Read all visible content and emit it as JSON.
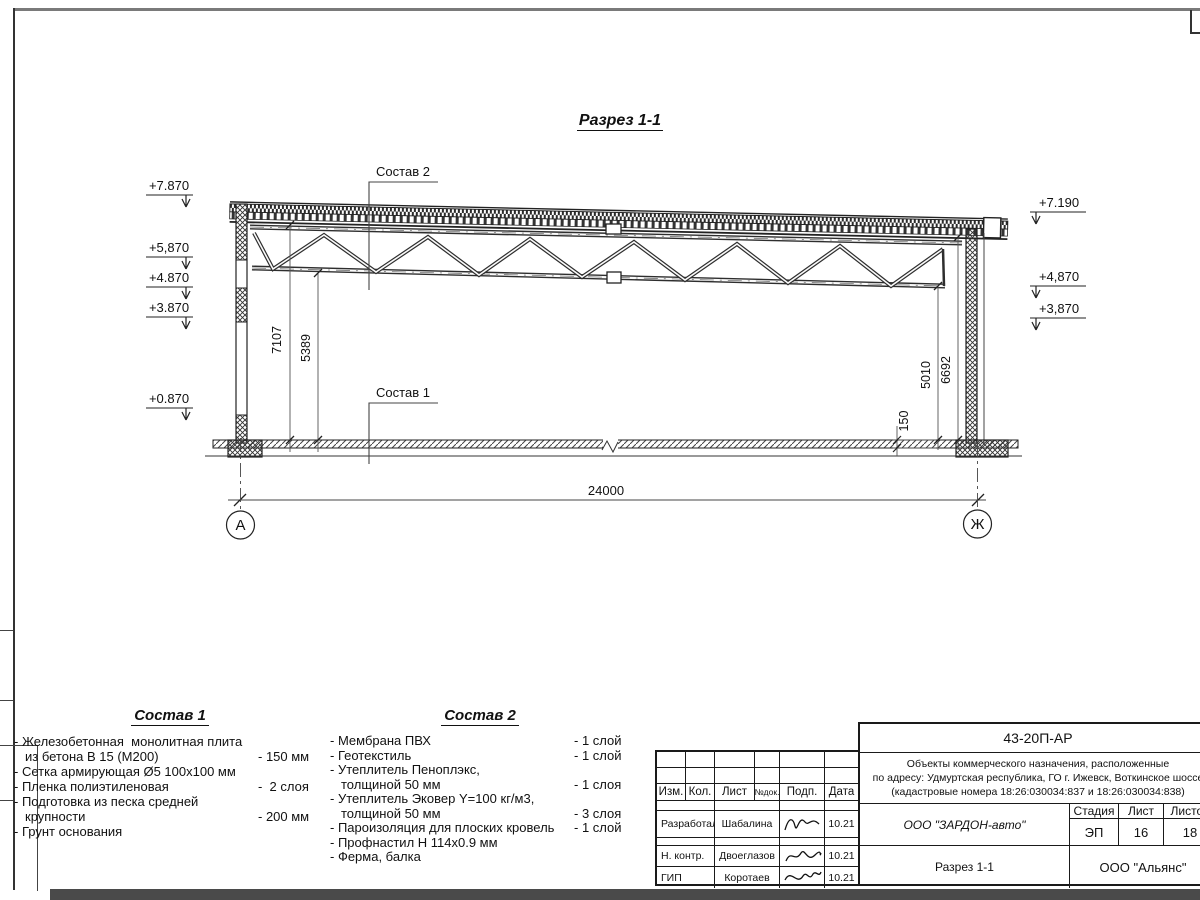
{
  "drawing": {
    "section_title": "Разрез 1-1",
    "label_sostav1": "Состав 1",
    "label_sostav2": "Состав 2",
    "elev_left": [
      "+7.870",
      "+5,870",
      "+4.870",
      "+3.870",
      "+0.870"
    ],
    "elev_right": [
      "+7.190",
      "+4,870",
      "+3,870"
    ],
    "dim_span": "24000",
    "dim_h_left1": "7107",
    "dim_h_left2": "5389",
    "dim_h_right1": "5010",
    "dim_h_right2": "6692",
    "dim_slab": "150",
    "axis_left": "А",
    "axis_right": "Ж"
  },
  "sostav1": {
    "title": "Состав 1",
    "lines": [
      {
        "text": "- Железобетонная  монолитная плита",
        "value": "",
        "indent": false
      },
      {
        "text": "из бетона В 15 (М200)",
        "value": "- 150 мм",
        "indent": true
      },
      {
        "text": "- Сетка армирующая Ø5 100х100 мм",
        "value": "",
        "indent": false
      },
      {
        "text": "- Пленка полиэтиленовая",
        "value": "-  2 слоя",
        "indent": false
      },
      {
        "text": "- Подготовка из песка средней",
        "value": "",
        "indent": false
      },
      {
        "text": "крупности",
        "value": "- 200 мм",
        "indent": true
      },
      {
        "text": "- Грунт основания",
        "value": "",
        "indent": false
      }
    ]
  },
  "sostav2": {
    "title": "Состав 2",
    "lines": [
      {
        "text": "- Мембрана ПВХ",
        "value": "- 1 слой",
        "indent": false
      },
      {
        "text": "- Геотекстиль",
        "value": "- 1 слой",
        "indent": false
      },
      {
        "text": "- Утеплитель Пеноплэкс,",
        "value": "",
        "indent": false
      },
      {
        "text": "толщиной 50 мм",
        "value": "- 1 слоя",
        "indent": true
      },
      {
        "text": "- Утеплитель Эковер Y=100 кг/м3,",
        "value": "",
        "indent": false
      },
      {
        "text": "толщиной 50 мм",
        "value": "- 3 слоя",
        "indent": true
      },
      {
        "text": "- Пароизоляция для плоских кровель",
        "value": "- 1 слой",
        "indent": false
      },
      {
        "text": "- Профнастил Н 114х0.9 мм",
        "value": "",
        "indent": false
      },
      {
        "text": "- Ферма, балка",
        "value": "",
        "indent": false
      }
    ]
  },
  "titleblock": {
    "doc_number": "43-20П-АР",
    "project_line1": "Объекты коммерческого назначения, расположенные",
    "project_line2": "по адресу: Удмуртская республика, ГО г. Ижевск, Воткинское шоссе",
    "project_line3": "(кадастровые номера 18:26:030034:837 и 18:26:030034:838)",
    "col_izm": "Изм.",
    "col_kol": "Кол.",
    "col_list": "Лист",
    "col_ndok": "№док.",
    "col_podp": "Подп.",
    "col_data": "Дата",
    "row_developed_label": "Разработал",
    "row_developed_name": "Шабалина",
    "row_developed_date": "10.21",
    "row_ncontrol_label": "Н. контр.",
    "row_ncontrol_name": "Двоеглазов",
    "row_ncontrol_date": "10.21",
    "row_gip_label": "ГИП",
    "row_gip_name": "Коротаев",
    "row_gip_date": "10.21",
    "company": "ООО \"ЗАРДОН-авто\"",
    "stage_label": "Стадия",
    "sheet_label": "Лист",
    "sheets_label": "Листов",
    "stage_value": "ЭП",
    "sheet_value": "16",
    "sheets_value": "18",
    "sheet_title": "Разрез 1-1",
    "org": "ООО \"Альянс\""
  }
}
